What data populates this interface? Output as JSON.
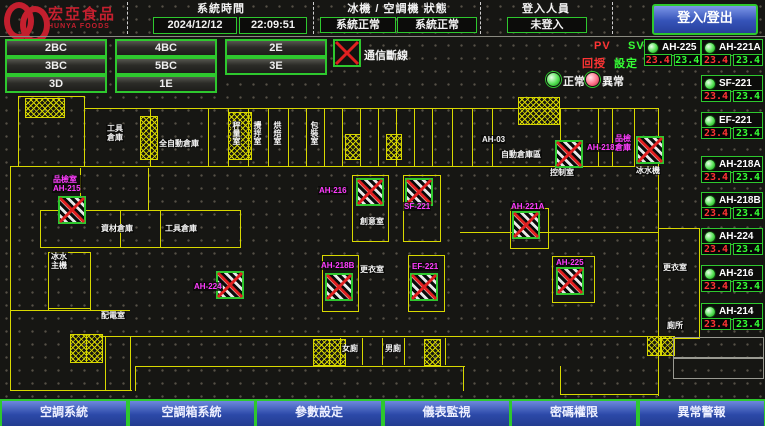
{
  "header": {
    "logo_title": "宏亞食品",
    "logo_subtitle": "HUNYA FOODS",
    "system_time_label": "系統時間",
    "date": "2024/12/12",
    "time": "22:09:51",
    "machine_status_label": "冰機 / 空調機 狀態",
    "chiller_status": "系統正常",
    "ahu_status": "系統正常",
    "login_label": "登入人員",
    "login_status": "未登入",
    "login_button": "登入/登出"
  },
  "floor_buttons": [
    "2BC",
    "4BC",
    "2E",
    "3BC",
    "5BC",
    "3E",
    "3D",
    "1E"
  ],
  "legend": {
    "comm_loss_icon": "comm-lost-x",
    "comm_loss": "通信斷線",
    "normal": "正常",
    "abnormal": "異常",
    "pv": "PV",
    "sv": "SV",
    "pv_desc": "回授",
    "sv_desc": "設定",
    "colors": {
      "pv": "#ff3434",
      "sv": "#35ff35",
      "border": "#2ec82e",
      "magenta": "#ff3cff",
      "wall": "#d8d800"
    }
  },
  "units": [
    {
      "name": "AH-225",
      "pv": "23.4",
      "sv": "23.4",
      "col": 1,
      "y": 39
    },
    {
      "name": "AH-221A",
      "pv": "23.4",
      "sv": "23.4",
      "col": 2,
      "y": 39
    },
    {
      "name": "SF-221",
      "pv": "23.4",
      "sv": "23.4",
      "col": 2,
      "y": 75
    },
    {
      "name": "EF-221",
      "pv": "23.4",
      "sv": "23.4",
      "col": 2,
      "y": 112
    },
    {
      "name": "AH-218A",
      "pv": "23.4",
      "sv": "23.4",
      "col": 2,
      "y": 156
    },
    {
      "name": "AH-218B",
      "pv": "23.4",
      "sv": "23.4",
      "col": 2,
      "y": 192
    },
    {
      "name": "AH-224",
      "pv": "23.4",
      "sv": "23.4",
      "col": 2,
      "y": 228
    },
    {
      "name": "AH-216",
      "pv": "23.4",
      "sv": "23.4",
      "col": 2,
      "y": 265
    },
    {
      "name": "AH-214",
      "pv": "23.4",
      "sv": "23.4",
      "col": 2,
      "y": 303
    }
  ],
  "plan": {
    "labels": [
      {
        "text": "品檢室\nAH-215",
        "x": 52,
        "y": 175,
        "color": "m"
      },
      {
        "text": "AH-224",
        "x": 193,
        "y": 282,
        "color": "m"
      },
      {
        "text": "AH-216",
        "x": 318,
        "y": 186,
        "color": "m"
      },
      {
        "text": "SF-221",
        "x": 403,
        "y": 202,
        "color": "m"
      },
      {
        "text": "AH-218B",
        "x": 320,
        "y": 261,
        "color": "m"
      },
      {
        "text": "EF-221",
        "x": 411,
        "y": 262,
        "color": "m"
      },
      {
        "text": "AH-218A",
        "x": 586,
        "y": 143,
        "color": "m"
      },
      {
        "text": "品檢\n倉庫",
        "x": 614,
        "y": 134,
        "color": "m"
      },
      {
        "text": "AH-221A",
        "x": 510,
        "y": 202,
        "color": "m"
      },
      {
        "text": "AH-225",
        "x": 555,
        "y": 258,
        "color": "m"
      },
      {
        "text": "AH-03",
        "x": 481,
        "y": 135,
        "color": "w"
      },
      {
        "text": "工具\n倉庫",
        "x": 106,
        "y": 124,
        "color": "w"
      },
      {
        "text": "全自動倉庫",
        "x": 158,
        "y": 139,
        "color": "w"
      },
      {
        "text": "秤量室",
        "x": 231,
        "y": 121,
        "color": "w",
        "vertical": true
      },
      {
        "text": "攪拌室",
        "x": 252,
        "y": 121,
        "color": "w",
        "vertical": true
      },
      {
        "text": "烘焙室",
        "x": 272,
        "y": 121,
        "color": "w",
        "vertical": true
      },
      {
        "text": "包裝室",
        "x": 309,
        "y": 121,
        "color": "w",
        "vertical": true
      },
      {
        "text": "自動倉庫區",
        "x": 500,
        "y": 150,
        "color": "w"
      },
      {
        "text": "控制室",
        "x": 549,
        "y": 168,
        "color": "w"
      },
      {
        "text": "冰水機",
        "x": 635,
        "y": 166,
        "color": "w"
      },
      {
        "text": "創意室",
        "x": 359,
        "y": 217,
        "color": "w"
      },
      {
        "text": "更衣室",
        "x": 359,
        "y": 265,
        "color": "w"
      },
      {
        "text": "資材倉庫",
        "x": 100,
        "y": 224,
        "color": "w"
      },
      {
        "text": "工具倉庫",
        "x": 164,
        "y": 224,
        "color": "w"
      },
      {
        "text": "配電室",
        "x": 100,
        "y": 311,
        "color": "w"
      },
      {
        "text": "冰水\n主機",
        "x": 50,
        "y": 252,
        "color": "w"
      },
      {
        "text": "女廁",
        "x": 341,
        "y": 344,
        "color": "w"
      },
      {
        "text": "男廁",
        "x": 384,
        "y": 344,
        "color": "w"
      },
      {
        "text": "更衣室",
        "x": 662,
        "y": 263,
        "color": "w"
      },
      {
        "text": "廁所",
        "x": 666,
        "y": 321,
        "color": "w"
      }
    ],
    "comm_lost_icons": [
      {
        "x": 58,
        "y": 196
      },
      {
        "x": 216,
        "y": 271
      },
      {
        "x": 356,
        "y": 178
      },
      {
        "x": 405,
        "y": 178
      },
      {
        "x": 325,
        "y": 273
      },
      {
        "x": 410,
        "y": 273
      },
      {
        "x": 555,
        "y": 140
      },
      {
        "x": 636,
        "y": 136
      },
      {
        "x": 512,
        "y": 211
      },
      {
        "x": 556,
        "y": 267
      }
    ]
  },
  "bottom_buttons": [
    "空調系統",
    "空調箱系統",
    "參數設定",
    "儀表監視",
    "密碼權限",
    "異常警報"
  ]
}
